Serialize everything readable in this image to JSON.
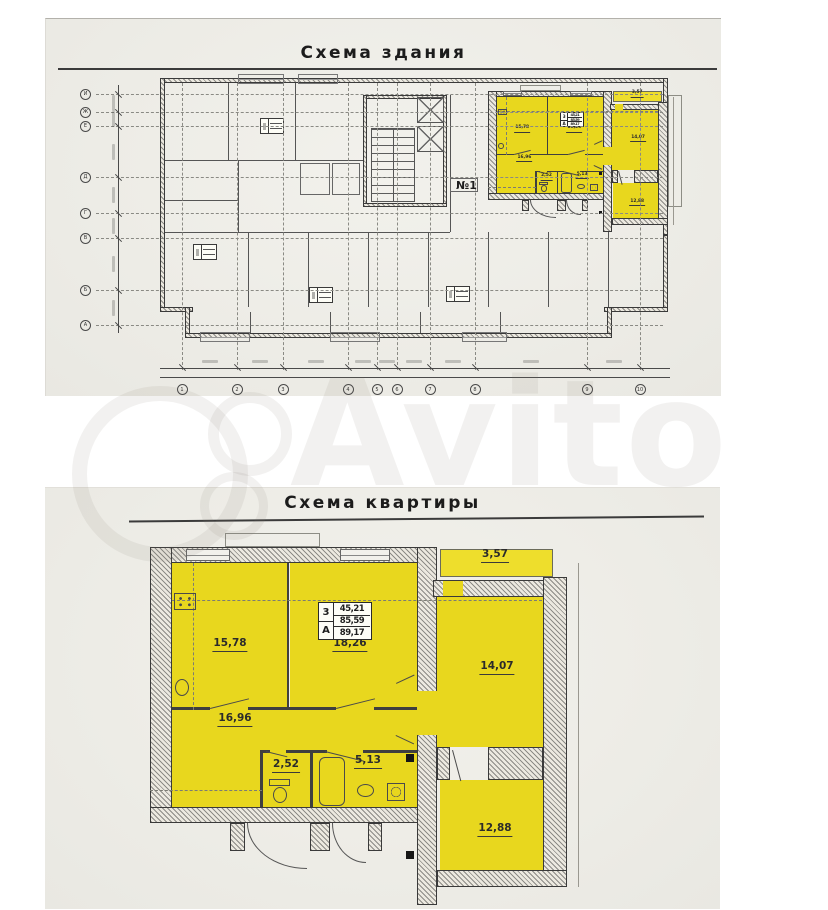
{
  "watermark": {
    "text": "Avito"
  },
  "colors": {
    "highlight": "#e8d71e",
    "balcony": "#eede2c",
    "paper": "#edece7",
    "line": "#3f3f3f"
  },
  "building_plan": {
    "title": "Схема здания",
    "apartment_label": "№1",
    "axis_columns": [
      "1",
      "2",
      "3",
      "4",
      "5",
      "6",
      "7",
      "8",
      "9",
      "10"
    ],
    "axis_rows": [
      "И",
      "Ж",
      "Е",
      "Д",
      "Г",
      "В",
      "Б",
      "А"
    ]
  },
  "apartment_plan": {
    "title": "Схема квартиры",
    "stamp": {
      "rooms_count": "3",
      "type": "А",
      "living_area": "45,21",
      "floor_area": "85,59",
      "total_area": "89,17"
    },
    "rooms": [
      {
        "id": "kitchen",
        "area": "15,78"
      },
      {
        "id": "living-room",
        "area": "18,26"
      },
      {
        "id": "hallway",
        "area": "16,96"
      },
      {
        "id": "wc",
        "area": "2,52"
      },
      {
        "id": "bathroom",
        "area": "5,13"
      },
      {
        "id": "room-right",
        "area": "14,07"
      },
      {
        "id": "room-bottom",
        "area": "12,88"
      },
      {
        "id": "balcony",
        "area": "3,57"
      }
    ]
  }
}
